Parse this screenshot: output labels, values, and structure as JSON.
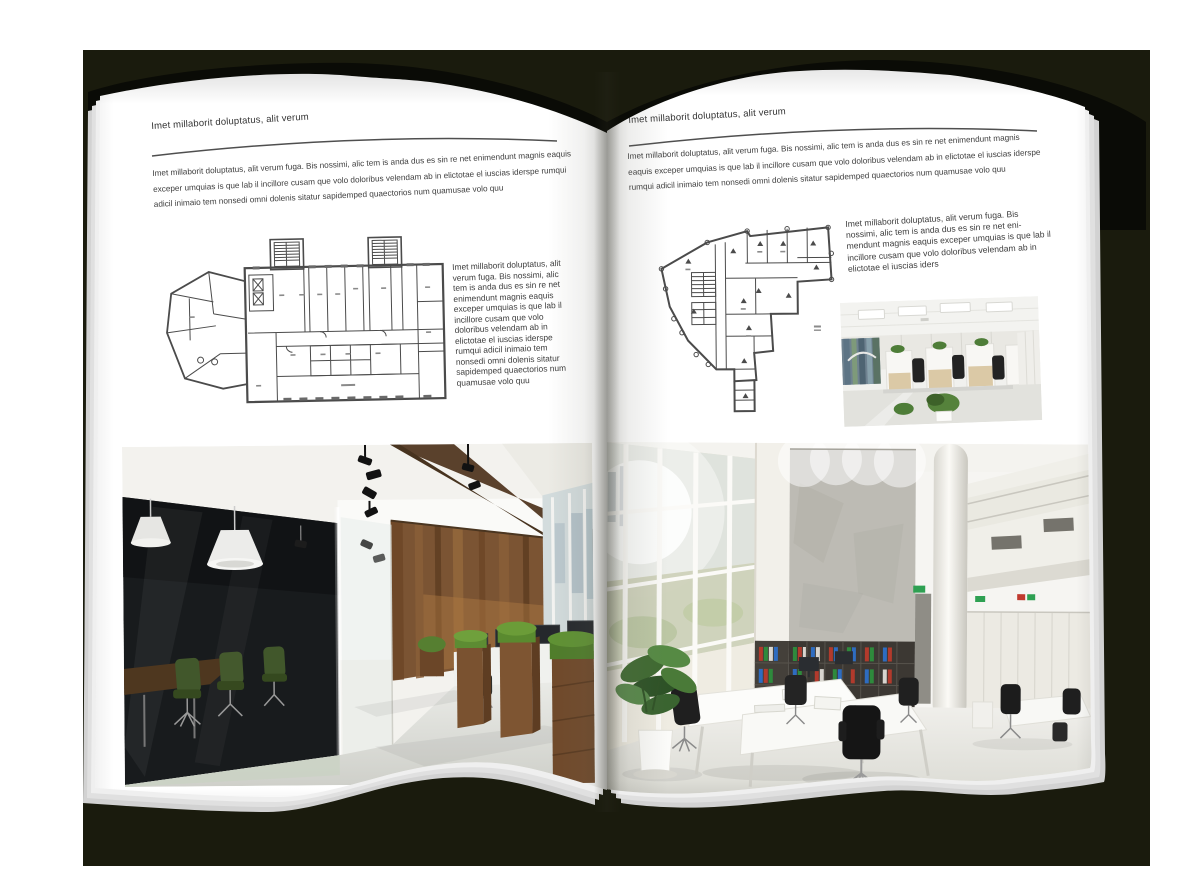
{
  "left_page": {
    "header": "Imet millaborit doluptatus, alit verum",
    "intro": "Imet millaborit doluptatus, alit verum fuga. Bis nossimi, alic tem is anda dus es sin re net enimendunt magnis eaquis exceper umquias is que lab il incillore cusam que volo doloribus velendam ab in elictotae el iuscias iderspe rumqui adicil inimaio tem nonsedi omni dolenis sitatur sapidemped quaectorios num quamusae volo quu",
    "side_text": "Imet millaborit doluptatus, alit verum fuga. Bis nossimi, alic tem is anda dus es sin re net enimendunt magnis eaquis exceper umquias is que lab il incillore cusam que volo doloribus velendam ab in elictotae el iuscias iderspe rumqui adicil inimaio tem nonsedi omni dolenis sitatur sapidemped quaectorios num quamusae volo quu"
  },
  "right_page": {
    "header": "Imet millaborit doluptatus, alit verum",
    "intro": "Imet millaborit doluptatus, alit verum fuga. Bis nossimi, alic tem is anda dus es sin re net enimendunt magnis eaquis exceper umquias is que lab il incillore cusam que volo doloribus velendam ab in elictotae el iuscias iderspe rumqui adicil inimaio tem nonsedi omni dolenis sitatur sapidemped quaectorios num quamusae volo quu",
    "side_text": "Imet millaborit doluptatus, alit verum fuga. Bis nossimi, alic tem is anda dus es sin re net eni- mendunt magnis eaquis exceper umquias is que lab il incillore cusam que volo doloribus velendam ab in elictotae el iuscias iders"
  },
  "palette": {
    "backdrop": "#1a1b0d",
    "cover": "#0a0b06",
    "page": "#ffffff",
    "text": "#3a3a3a",
    "wood": "#7b5433",
    "plant_green": "#5d8c33",
    "binder_red": "#b23a2c",
    "binder_green": "#2e8a3c",
    "binder_blue": "#2e6cc0"
  }
}
